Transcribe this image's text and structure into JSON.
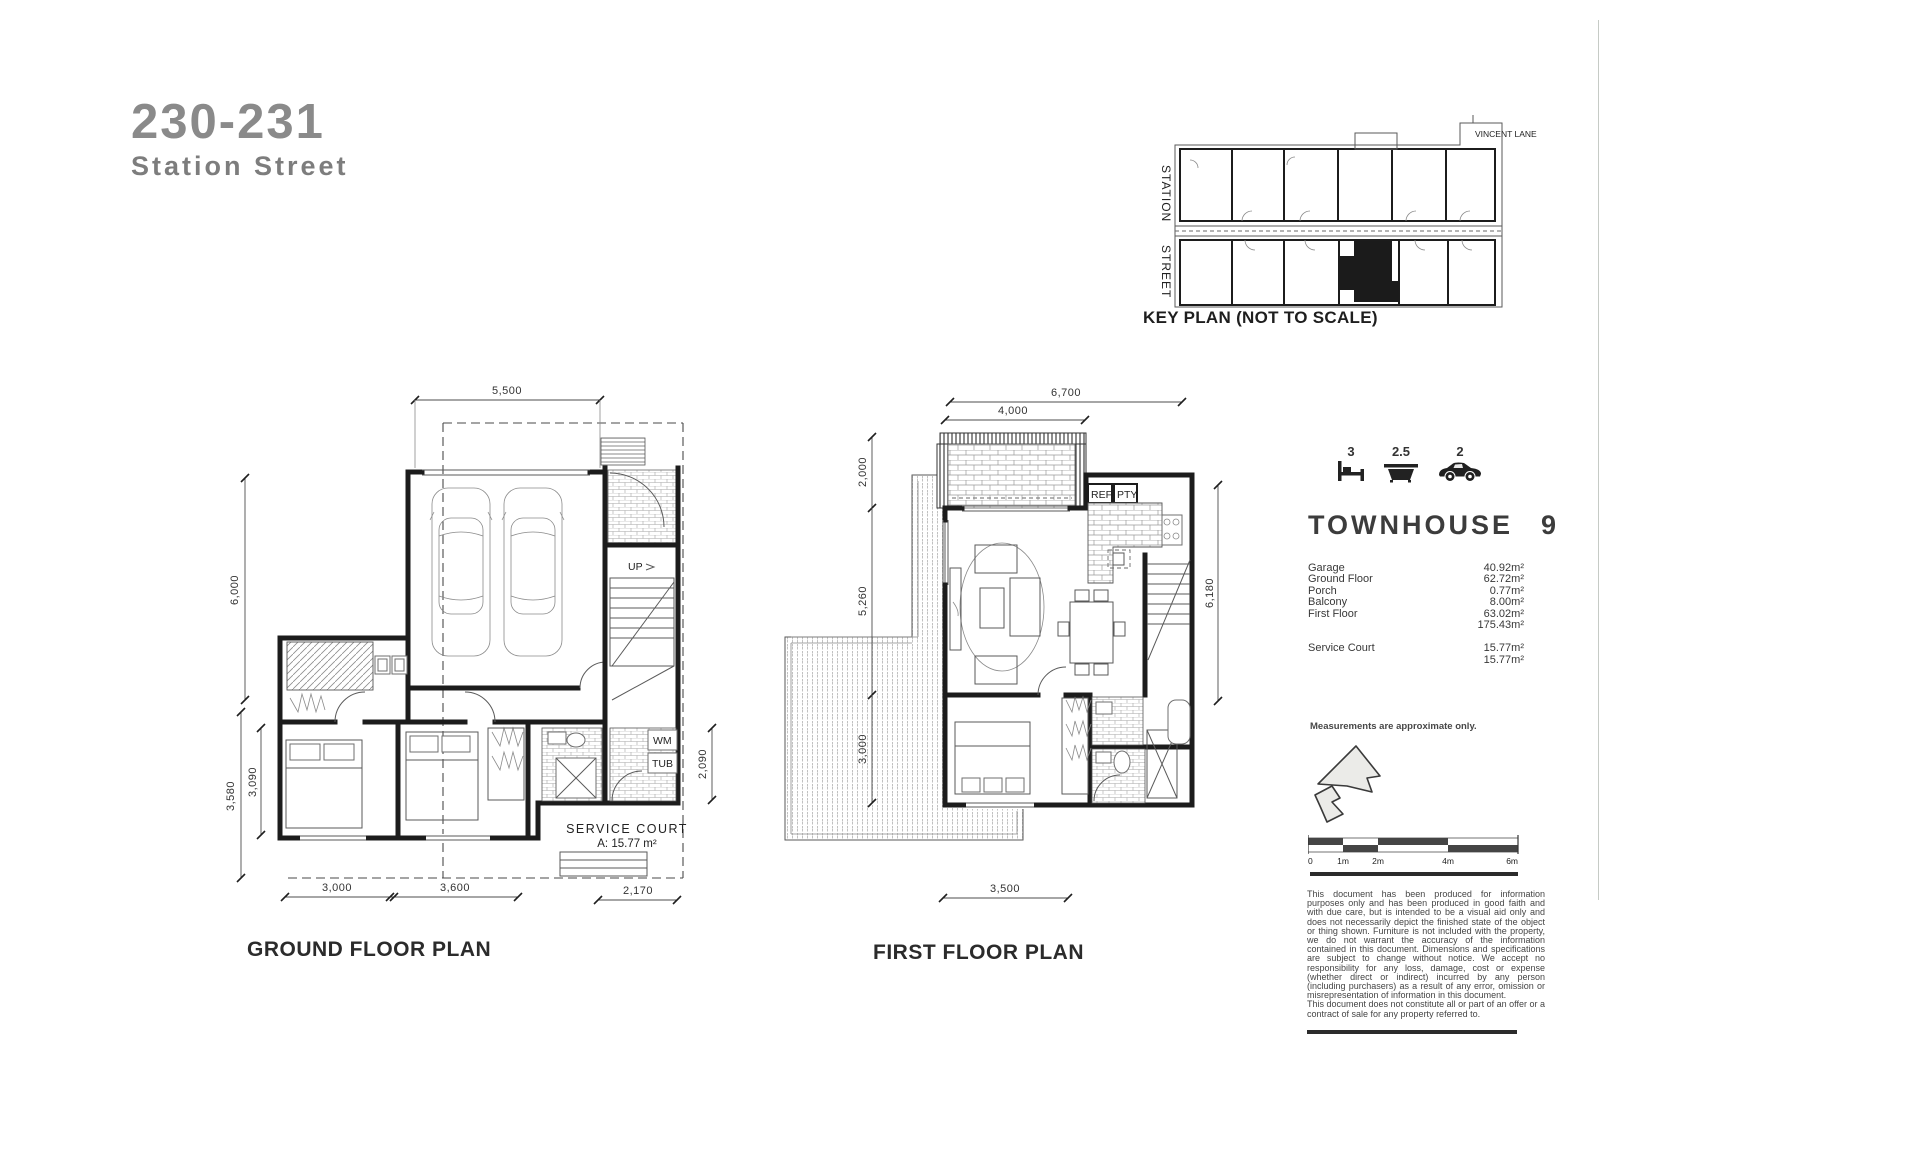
{
  "header": {
    "lot": "230-231",
    "street": "Station Street"
  },
  "key_plan": {
    "lane": "VINCENT LANE",
    "street_word1": "STATION",
    "street_word2": "STREET",
    "caption": "KEY PLAN (NOT TO SCALE)"
  },
  "ground_floor": {
    "caption": "GROUND FLOOR PLAN",
    "dims": {
      "top": "5,500",
      "left_upper": "6,000",
      "left_lower_outer": "3,580",
      "left_lower_inner": "3,090",
      "bottom_1": "3,000",
      "bottom_2": "3,600",
      "bottom_3": "2,170",
      "right": "2,090"
    },
    "labels": {
      "up": "UP",
      "wm": "WM",
      "tub": "TUB",
      "service_court": "SERVICE COURT",
      "service_court_area": "A: 15.77 m²"
    }
  },
  "first_floor": {
    "caption": "FIRST FLOOR PLAN",
    "dims": {
      "top": "6,700",
      "top_inner": "4,000",
      "left_upper": "2,000",
      "left_mid": "5,260",
      "left_lower": "3,000",
      "right": "6,180",
      "bottom": "3,500"
    },
    "labels": {
      "ref": "REF",
      "pty": "PTY"
    }
  },
  "summary": {
    "beds": "3",
    "baths": "2.5",
    "cars": "2",
    "name": "TOWNHOUSE",
    "unit": "9",
    "areas": [
      {
        "label": "Garage",
        "value": "40.92m²"
      },
      {
        "label": "Ground Floor",
        "value": "62.72m²"
      },
      {
        "label": "Porch",
        "value": "0.77m²"
      },
      {
        "label": "Balcony",
        "value": "8.00m²"
      },
      {
        "label": "First Floor",
        "value": "63.02m²"
      },
      {
        "label": "",
        "value": "175.43m²"
      }
    ],
    "service_areas": [
      {
        "label": "Service Court",
        "value": "15.77m²"
      },
      {
        "label": "",
        "value": "15.77m²"
      }
    ],
    "note": "Measurements are approximate only.",
    "scale": {
      "t0": "0",
      "t1": "1m",
      "t2": "2m",
      "t4": "4m",
      "t6": "6m"
    },
    "disclaimer_p1": "This document has been produced for information purposes only and has been produced in good faith and with due care, but is intended to be a visual aid only and does not necessarily depict the finished state of the object or thing shown. Furniture is not included with the property, we do not warrant the accuracy of the information contained in this document. Dimensions and specifications are subject to change without notice. We accept no responsibility for any loss, damage, cost or expense (whether direct or indirect) incurred by any person (including purchasers) as a result of any error, omission or misrepresentation of information in this document.",
    "disclaimer_p2": "This document does not constitute all or part of an offer or a contract of sale for any property referred to."
  }
}
